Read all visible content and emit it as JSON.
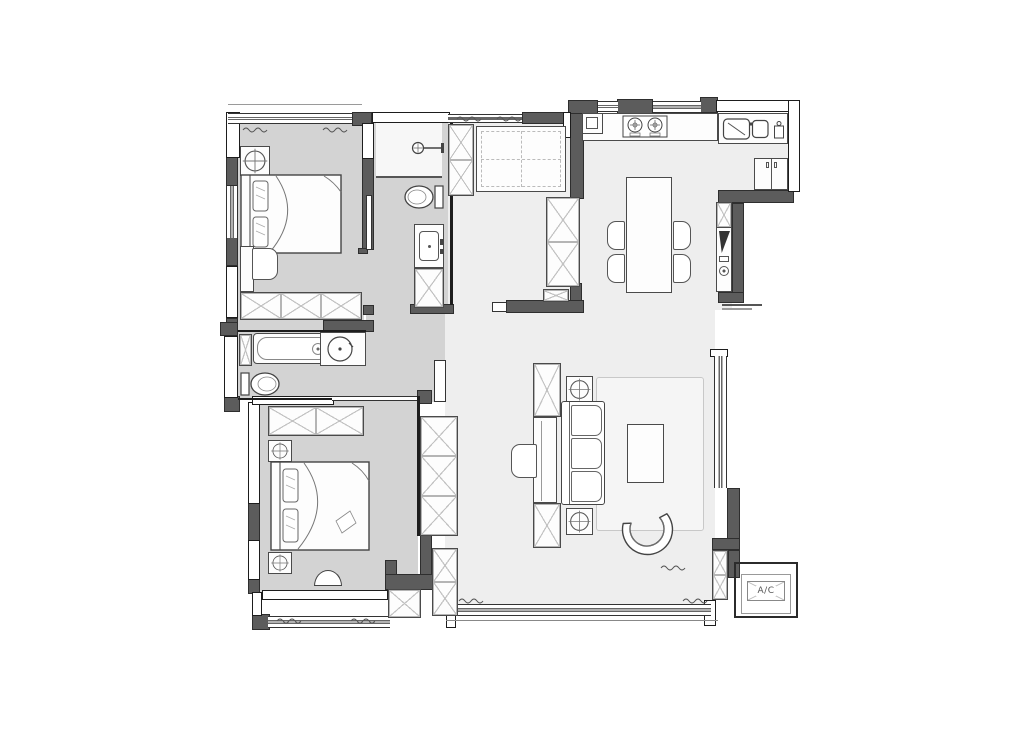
{
  "labels": {
    "ac": "A/C"
  },
  "colors": {
    "background": "#ffffff",
    "wall_dark": "#5c5c5c",
    "line_strong": "#1d1d1d",
    "line_medium": "#4a4a4a",
    "line_light": "#9a9a9a",
    "floor_private": "#d3d3d3",
    "floor_common": "#eeeeee",
    "floor_shower": "#f7f7f7",
    "rug": "#f5f5f5",
    "furniture_fill": "#fdfdfd",
    "cabinet_hatch": "#c2c2c2"
  },
  "legend": {
    "drawing_type": "apartment-floor-plan",
    "rooms": [
      "master-bedroom",
      "master-bathroom",
      "entry",
      "kitchen",
      "dining-area",
      "hallway",
      "second-bathroom",
      "second-bedroom",
      "living-room",
      "balcony",
      "ac-platform"
    ],
    "furniture": [
      "double-bed",
      "nightstand",
      "wardrobe",
      "desk",
      "chair",
      "shower-head",
      "toilet",
      "vanity-sink",
      "shoe-cabinet",
      "storage-bench",
      "tall-cabinet",
      "cooktop",
      "kitchen-sink",
      "water-purifier",
      "refrigerator",
      "appliance-column",
      "dining-table",
      "dining-chair",
      "bathtub",
      "round-basin",
      "media-cabinet",
      "side-table",
      "sofa",
      "coffee-table",
      "armchair",
      "rug",
      "stool",
      "air-conditioner-box"
    ]
  }
}
